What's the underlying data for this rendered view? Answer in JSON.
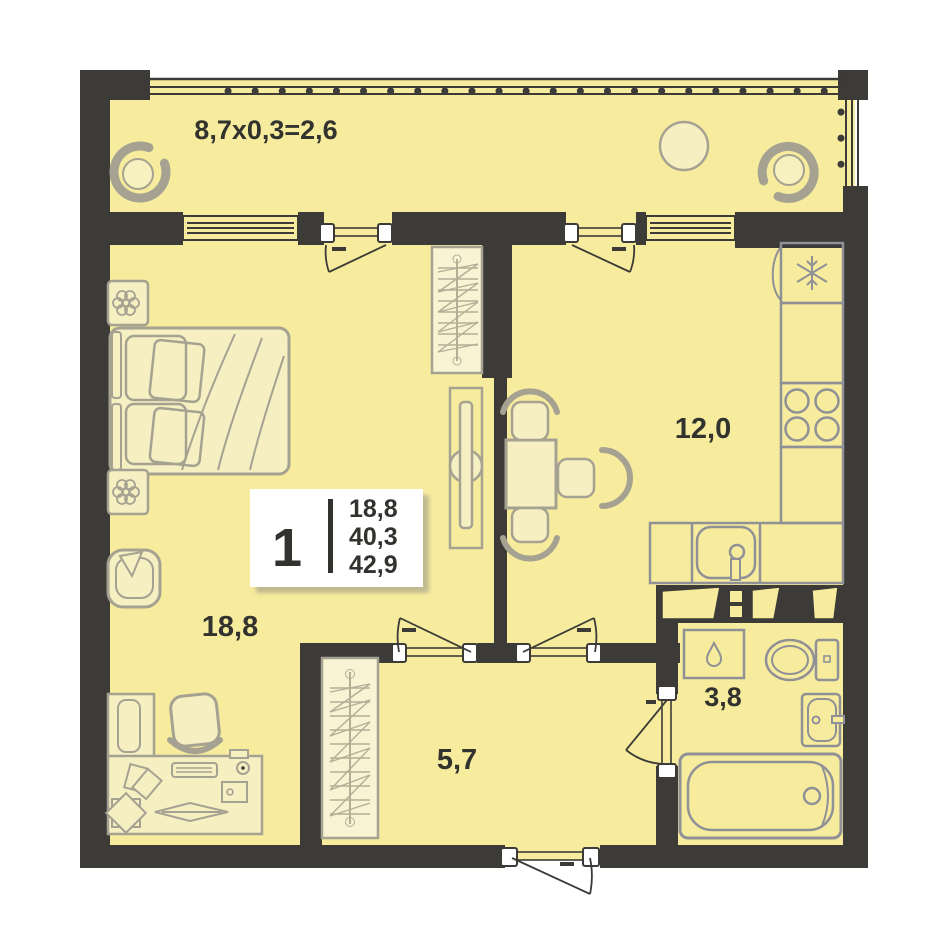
{
  "title": "apartment-floor-plan-1-room",
  "stats_card": {
    "rooms": "1",
    "living_area": "18,8",
    "total_area": "40,3",
    "total_with_balcony": "42,9"
  },
  "labels": {
    "balcony": "8,7x0,3=2,6",
    "living": "18,8",
    "kitchen": "12,0",
    "hallway": "5,7",
    "bathroom": "3,8"
  },
  "colors": {
    "background": "#FFFFFF",
    "floor": "#F7EC9D",
    "wall": "#3C3B38",
    "furniture_stroke": "#A6A291",
    "furniture_fill": "#F5EFC2",
    "wardrobe_fill": "#F8F3D3",
    "hatch_stroke": "#B3AF97",
    "fixture_stroke": "#8F9196",
    "text": "#32322E",
    "card_background": "#FFFFFF",
    "card_shadow": "#BDB68D"
  },
  "furniture_icons": {
    "balcony": [
      "lounge-chair-icon",
      "round-table-icon",
      "lounge-chair-icon"
    ],
    "living": [
      "plant-icon",
      "double-bed-icon",
      "plant-icon",
      "armchair-icon",
      "tv-stand-icon",
      "wardrobe-icon",
      "shelf-icon",
      "desk-icon",
      "desk-chair-icon"
    ],
    "kitchen": [
      "fridge-icon",
      "counter-icon",
      "stove-icon",
      "kitchen-sink-icon",
      "dining-table-icon",
      "chair-icon"
    ],
    "hallway": [
      "wardrobe-icon"
    ],
    "bathroom": [
      "washing-machine-icon",
      "toilet-icon",
      "sink-icon",
      "bathtub-icon"
    ]
  }
}
